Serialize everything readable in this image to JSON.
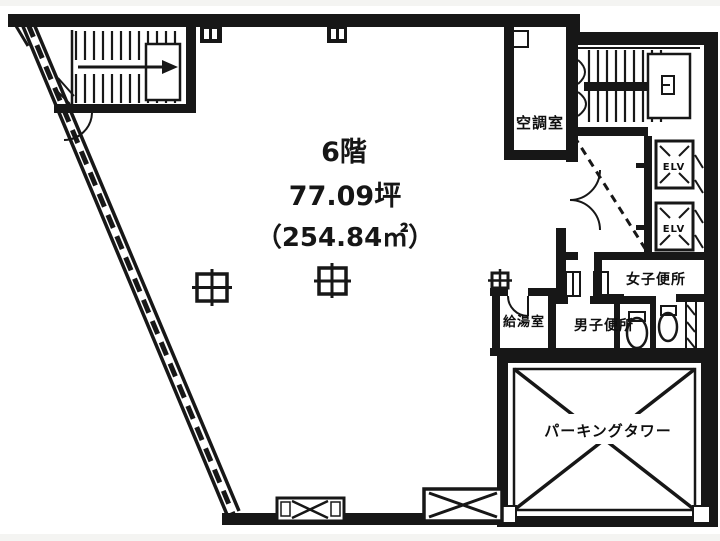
{
  "page": {
    "background_color": "#f4f4f2",
    "paper_color": "#ffffff",
    "ink_color": "#1c1c1c"
  },
  "floor_info": {
    "floor": "6階",
    "area_tsubo": "77.09坪",
    "area_sqm": "（254.84㎡）"
  },
  "room_labels": {
    "ac_room": "空調室",
    "elevator": "ELV",
    "womens_toilet": "女子便所",
    "mens_toilet": "男子便所",
    "kitchenette": "給湯室",
    "parking_tower": "パーキングタワー"
  }
}
